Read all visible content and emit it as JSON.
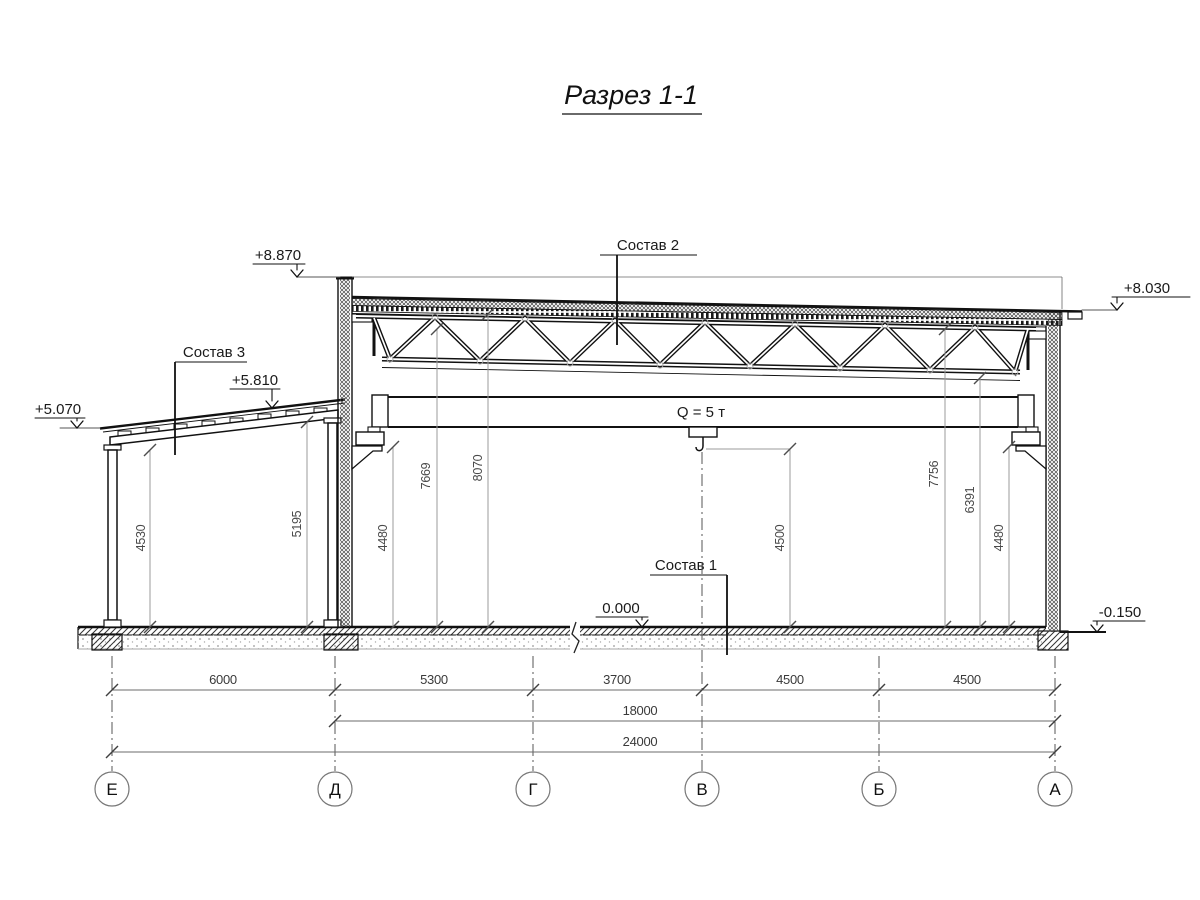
{
  "title": "Разрез 1-1",
  "elev": {
    "m8870": "+8.870",
    "m8030": "+8.030",
    "m5810": "+5.810",
    "m5070": "+5.070",
    "m0000": "0.000",
    "m0150": "-0.150"
  },
  "callouts": {
    "sostav2": "Состав 2",
    "sostav3": "Состав 3",
    "sostav1": "Состав 1"
  },
  "crane": {
    "capacity": "Q = 5 т"
  },
  "vdims": {
    "d4530": "4530",
    "d5195": "5195",
    "d4480l": "4480",
    "d7669": "7669",
    "d8070": "8070",
    "d4500": "4500",
    "d7756": "7756",
    "d6391": "6391",
    "d4480r": "4480"
  },
  "hdims": {
    "row1": [
      "6000",
      "5300",
      "3700",
      "4500",
      "4500"
    ],
    "row2": "18000",
    "row3": "24000"
  },
  "axes": [
    "Е",
    "Д",
    "Г",
    "В",
    "Б",
    "А"
  ]
}
